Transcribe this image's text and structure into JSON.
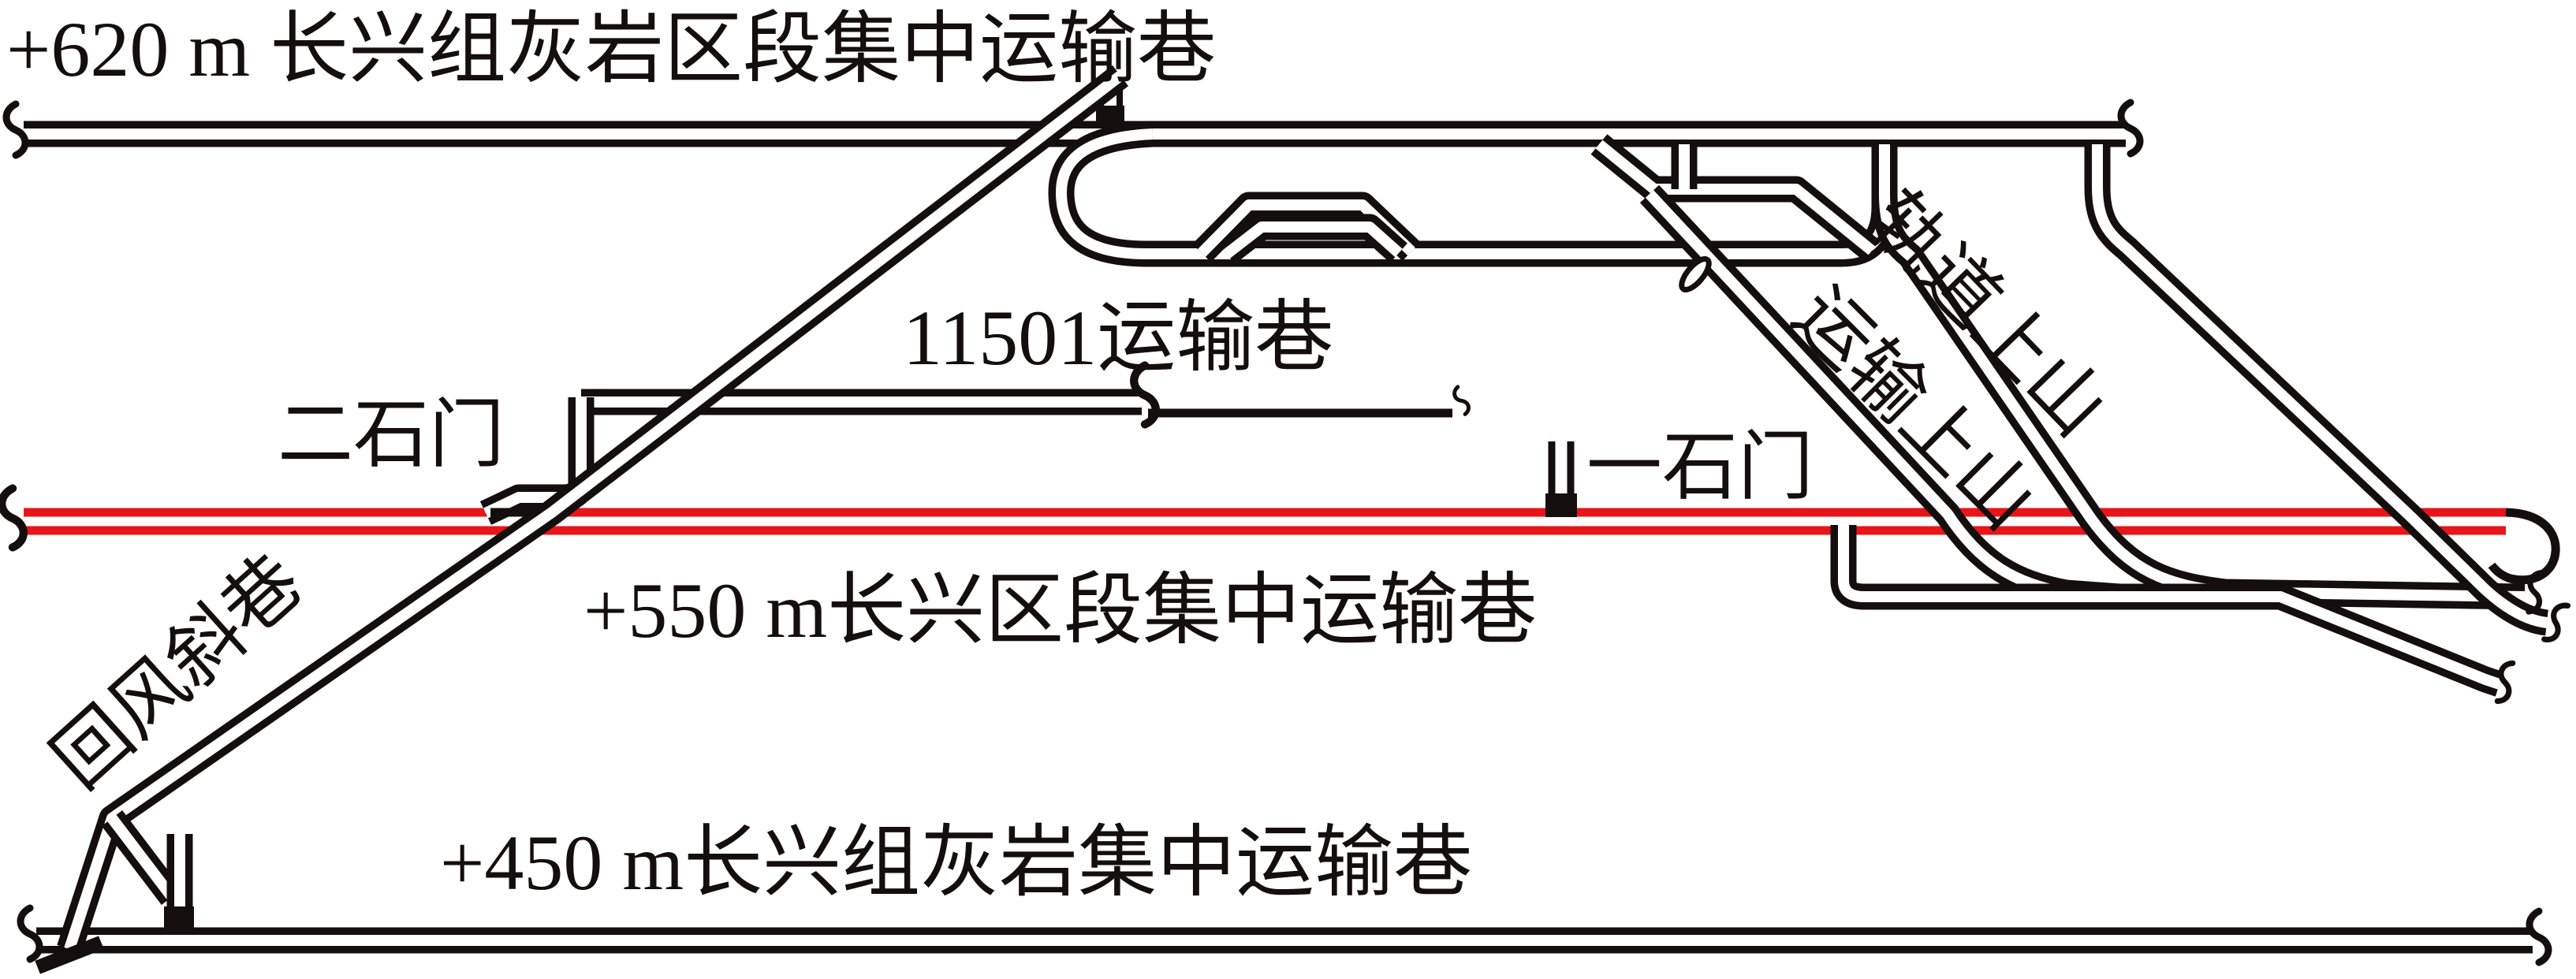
{
  "figure": {
    "type": "mine-roadway-layout-diagram",
    "background_color": "#ffffff",
    "line_color": "#140e0e",
    "highlight_color": "#e8151a"
  },
  "labels": {
    "level_620": "+620 m 长兴组灰岩区段集中运输巷",
    "roadway_11501": "11501运输巷",
    "crosscut_2": "二石门",
    "crosscut_1": "一石门",
    "level_550": "+550 m长兴区段集中运输巷",
    "level_450": "+450 m长兴组灰岩集中运输巷",
    "return_air_incline": "回风斜巷",
    "haulage_rise": "运输上山",
    "track_rise": "轨道上山"
  }
}
